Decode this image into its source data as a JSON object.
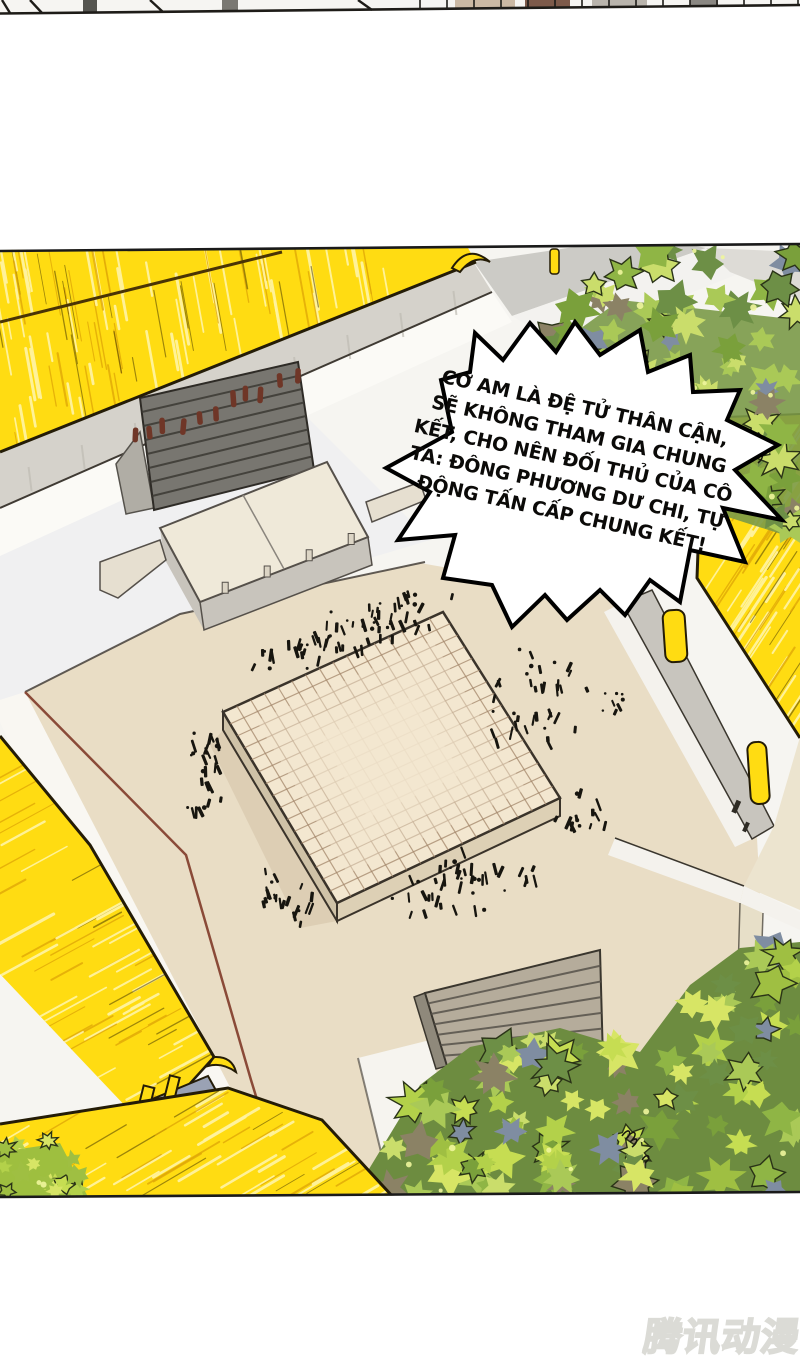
{
  "speech_bubble": {
    "lines": [
      "CƠ AM LÀ ĐỆ TỬ THÂN CẬN,",
      "SẼ KHÔNG THAM GIA CHUNG",
      "KẾT, CHO NÊN ĐỐI THỦ CỦA CÔ",
      "TA: ĐÔNG PHƯƠNG DƯ CHI, TỰ",
      "ĐỘNG TẤN CẤP CHUNG KẾT!"
    ]
  },
  "watermark": {
    "text": "腾讯动漫"
  },
  "colors": {
    "roof_yellow": "#ffdc12",
    "roof_streak_light": "#fff3a0",
    "roof_streak_gold": "#e0a808",
    "roof_streak_dark": "#3c2f00",
    "outline": "#241c07",
    "ink": "#17150f",
    "wall_gray": "#d5d2cb",
    "ground_beige": "#e9ddc5",
    "platform_top": "#f3e7d0",
    "grid_line": "#a3866a",
    "boundary_red": "#8a4a38",
    "beam_gray": "#9aa2b4",
    "figure_red": "#6f3627",
    "tree_greens": [
      "#cadd6b",
      "#aac957",
      "#8fb545",
      "#7aa03b",
      "#6d8f46"
    ],
    "tree_accents": [
      "#7f8da1",
      "#8b8265"
    ],
    "bush_greens": [
      "#d7e565",
      "#c6dd52",
      "#b3d14a",
      "#9fbf42"
    ],
    "leaf_dot": "#eef59c",
    "bubble_fill": "#ffffff",
    "bubble_stroke": "#000000",
    "watermark": "#efefec"
  }
}
